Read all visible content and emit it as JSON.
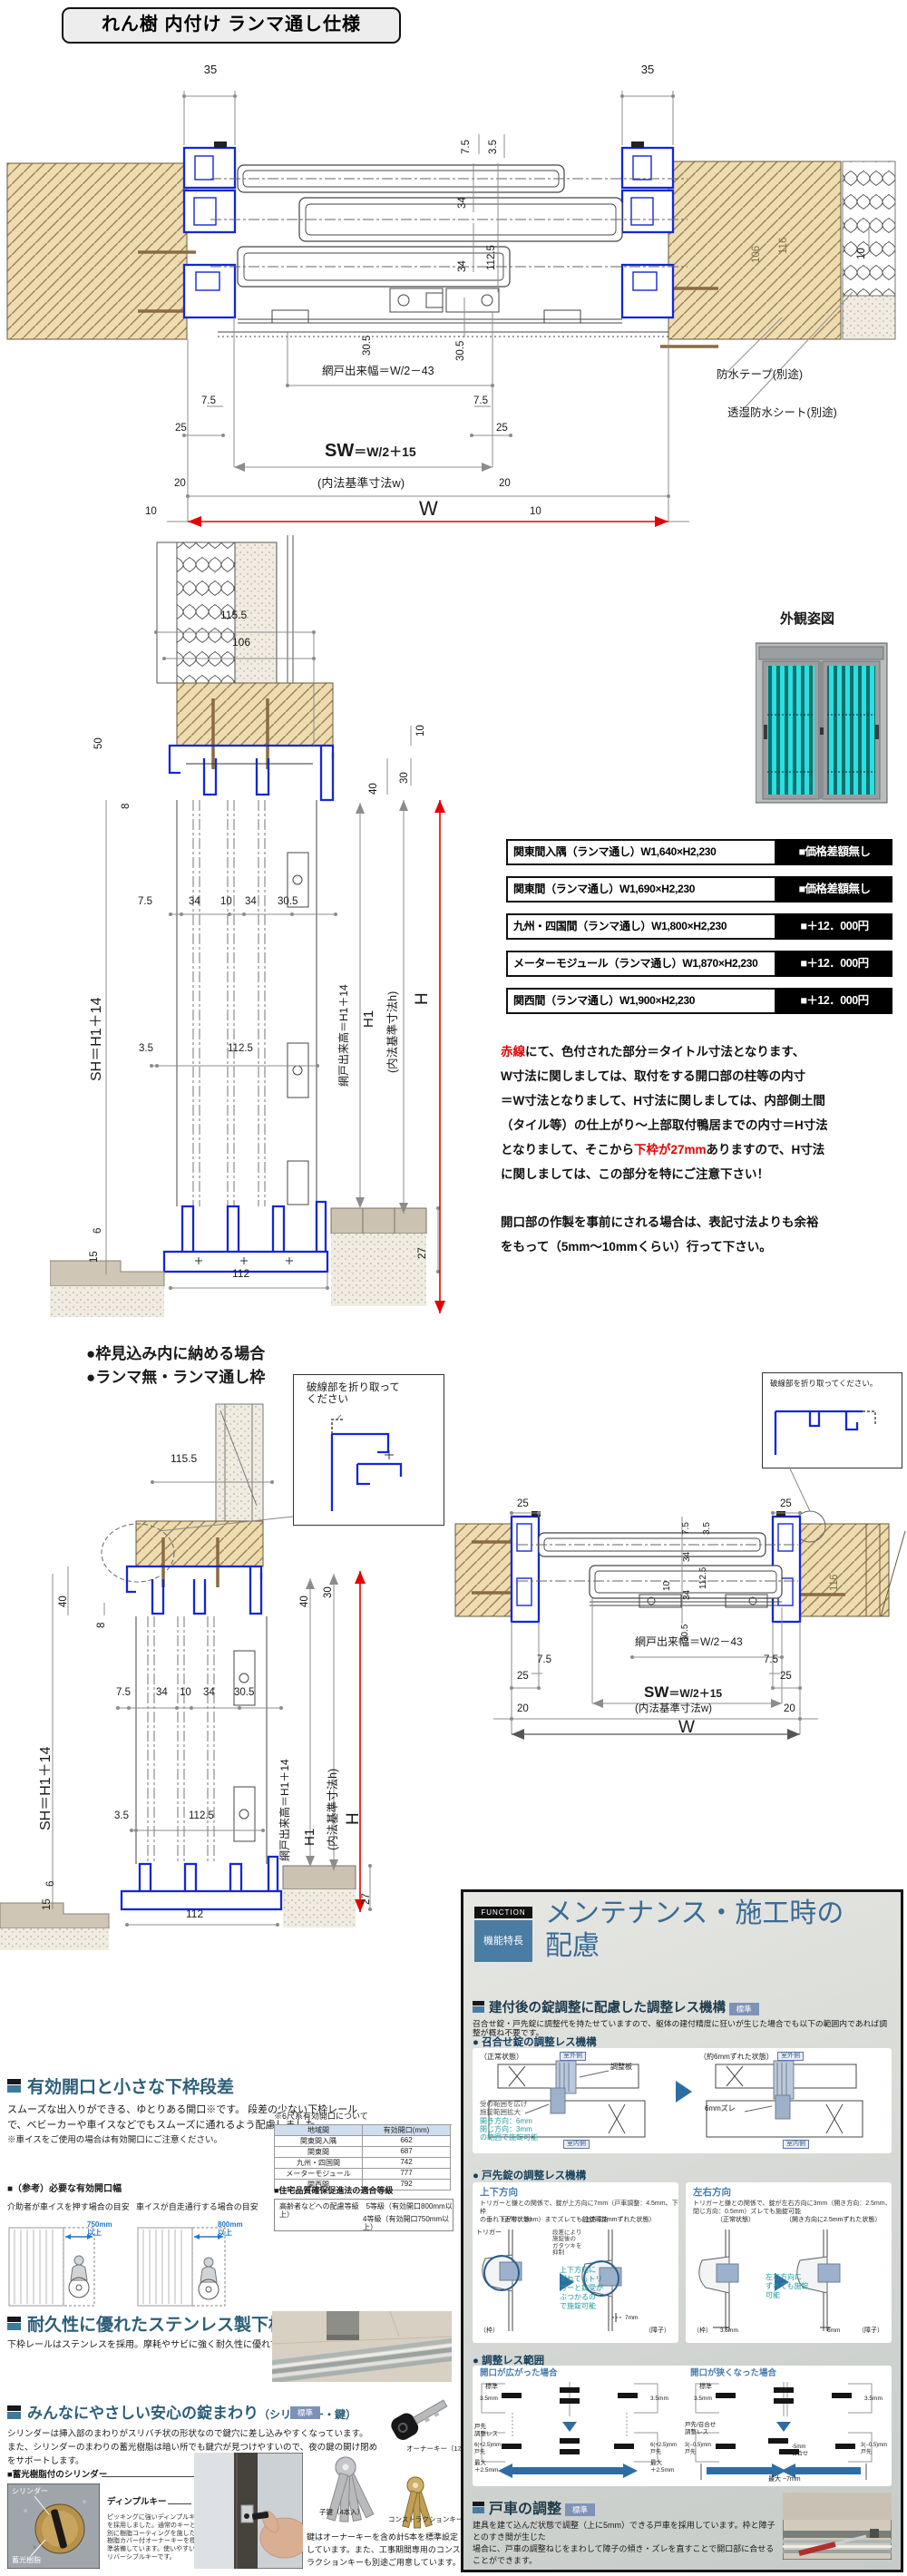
{
  "title": "れん樹 内付け ランマ通し仕様",
  "d1": {
    "l35": "35",
    "r35": "35",
    "v75": "7.5",
    "v35": "3.5",
    "v34a": "34",
    "v1125": "112.5",
    "v34b": "34",
    "v305": "30.5",
    "v10": "10",
    "w106": "106",
    "w116": "116",
    "amido": "網戸出来幅＝W/2－43",
    "b305": "30.5",
    "b75l": "7.5",
    "b75r": "7.5",
    "b25l": "25",
    "b25r": "25",
    "sw": "SW",
    "sweq": "＝W/2＋15",
    "naiho": "(内法基準寸法w)",
    "b20l": "20",
    "b20r": "20",
    "w": "W",
    "b10l": "10",
    "b10r": "10",
    "tape": "防水テープ(別途)",
    "sheet": "透湿防水シート(別途)"
  },
  "gaikan": "外観姿図",
  "price": {
    "rows": [
      {
        "label": "関東間入隅（ランマ通し）W1,640×H2,230",
        "price": "■価格差額無し"
      },
      {
        "label": "関東間（ランマ通し）W1,690×H2,230",
        "price": "■価格差額無し"
      },
      {
        "label": "九州・四国間（ランマ通し）W1,800×H2,230",
        "price": "■＋12．000円"
      },
      {
        "label": "メーターモジュール（ランマ通し）W1,870×H2,230",
        "price": "■＋12．000円"
      },
      {
        "label": "関西間（ランマ通し）W1,900×H2,230",
        "price": "■＋12．000円"
      }
    ]
  },
  "notes": {
    "l1r": "赤線",
    "l1": "にて、色付された部分＝タイトル寸法となります、",
    "l2": "W寸法に関しましては、取付をする開口部の柱等の内寸",
    "l3": "＝W寸法となりまして、H寸法に関しましては、内部側土間",
    "l4": "（タイル等）の仕上がり～上部取付鴨居までの内寸＝H寸法",
    "l5a": "となりまして、そこから",
    "l5r": "下枠が27mm",
    "l5b": "ありますので、H寸法",
    "l6": "に関しましては、この部分を特にご注意下さい！",
    "p2": "開口部の作製を事前にされる場合は、表記寸法よりも余裕\nをもって（5mm～10mmくらい）行って下さい。"
  },
  "d2": {
    "v1155": "115.5",
    "v106": "106",
    "t10": "10",
    "t40": "40",
    "t30": "30",
    "l50": "50",
    "l8": "8",
    "m75": "7.5",
    "m34a": "34",
    "m10": "10",
    "m34b": "34",
    "m305": "30.5",
    "sh": "SH＝H1＋14",
    "v35": "3.5",
    "v1125": "112.5",
    "amido": "網戸出来高＝H1＋14",
    "h1": "H1",
    "naiho": "(内法基準寸法h)",
    "h": "H",
    "b27": "27",
    "b112": "112",
    "l6": "6",
    "l15": "15"
  },
  "mid": {
    "h1": "●枠見込み内に納める場合",
    "h2": "●ランマ無・ランマ通し枠",
    "c1": "破線部を折り取って\nください",
    "c2": "破線部を折り取ってください。"
  },
  "secA": {
    "title": "有効開口と小さな下枠段差",
    "body": "スムーズな出入りができる、ゆとりある開口※です。 段差の少ない下枠レール\nで、ベビーカーや車イスなどでもスムーズに通れるよう配慮しました。",
    "note": "※車イスをご使用の場合は有効開口にご注意ください。",
    "ref": "■（参考）必要な有効開口幅",
    "cap1": "介助者が車イスを押す場合の目安",
    "cap2": "車イスが自走通行する場合の目安",
    "arw1": "750mm\n以上",
    "arw2": "800mm\n以上",
    "tbl": {
      "title": "※6尺系有効開口について",
      "h1": "地域間",
      "h2": "有効開口(mm)",
      "rows": [
        [
          "関東間入隅",
          "662"
        ],
        [
          "関東間",
          "687"
        ],
        [
          "九州・四国間",
          "742"
        ],
        [
          "メーターモジュール",
          "777"
        ],
        [
          "関西間",
          "792"
        ]
      ]
    },
    "grade": {
      "title": "■住宅品質確保促進法の適合等級",
      "l1": "高齢者などへの配慮等級　5等級（有効開口800mm以上）",
      "l2": "4等級（有効開口750mm以上）"
    }
  },
  "secB": {
    "title": "耐久性に優れたステンレス製下枠",
    "body": "下枠レールはステンレスを採用。摩耗やサビに強く耐久性に優れています。"
  },
  "secC": {
    "title": "みんなにやさしい安心の錠まわり",
    "sub_title": "（シリンダー・鍵）",
    "badge": "標準",
    "body": "シリンダーは挿入部のまわりがスリバチ状の形状なので鍵穴に差し込みやすくなっています。\nまた、シリンダーのまわりの蓄光樹脂は暗い所でも鍵穴が見つけやすいので、夜の鍵の開け閉め\nをサポートします。",
    "sub": "■蓄光樹脂付のシリンダー",
    "cyl": "シリンダー",
    "resin": "蓄光樹脂",
    "dimple": "ディンプルキー",
    "dimple_body": "ピッキングに強いディンプルキー\nを採用しました。通常のキーとは\n別に樹脂コーティングを施した\n樹脂カバー付オーナーキーを標\n準装備しています。使いやすい\nリバーシブルキーです。",
    "owner": "オーナーキー（1本入）",
    "child": "子鍵（4本入）",
    "constr": "コンストラクションキー",
    "keysnote": "鍵はオーナーキーを含め計5本を標準設定\nしています。また、工事期間専用のコンスト\nラクションキーも別途ご用意しています。"
  },
  "panel": {
    "fn": "FUNCTION",
    "kn": "機能特長",
    "t1": "メンテナンス・施工時の",
    "t2": "配慮",
    "badge": "標準",
    "s1": "建付後の錠調整に配慮した調整レス機構",
    "intro": "召合せ錠・戸先錠に調整代を持たせていますので、躯体の建付精度に狂いが生じた場合でも以下の範囲内であれば調整が概ね不要です。",
    "b1": "● 召合せ錠の調整レス機構",
    "normal": "（正常状態）",
    "outdoor": "室外側",
    "indoor": "室内側",
    "plate": "調整板",
    "range": "受の範囲を広げ\n施錠範囲拡大",
    "teal1": "開き方向：6mm\n閉じ方向：3mm\nの範囲で施錠可能",
    "shift6": "（約6mmずれた状態）",
    "zure": "6mmズレ",
    "b2": "● 戸先錠の調整レス機構",
    "ud": "上下方向",
    "ud_body": "トリガーと鎌との関係で、錠が上方向に7mm（戸車調整：4.5mm、下枠\nの垂れ下がり：2mm）までズレても施錠可能",
    "ud_shift": "（上方向7mmずれた状態）",
    "trigger": "トリガー",
    "gata": "段差により\n施錠後の\nガタツキを\n抑制",
    "ud_teal": "上下方向に\nずれてもトリ\nガーと錠受が\nぶつかるの\nで施錠可能",
    "waku": "（枠）",
    "shoji": "（障子）",
    "mm7": "7mm",
    "lr": "左右方向",
    "lr_body": "トリガーと鎌との関係で、錠が左右方向に3mm（開き方向：2.5mm、\n閉じ方向：0.5mm）ズレても施錠可能",
    "lr_shift": "（開き方向に2.5mmずれた状態）",
    "lr_teal": "左右方向に\nずれても施錠\n可能",
    "mm35": "3.5mm",
    "mm6": "6mm",
    "b3": "● 調整レス範囲",
    "case1": "開口が広がった場合",
    "case2": "開口が狭くなった場合",
    "std": "標準",
    "d35a": "3.5mm",
    "d35b": "3.5mm",
    "d35c": "3.5mm",
    "d35d": "3.5mm",
    "tres": "戸先\n調整レス",
    "v1l": "6(+2.5)mm\n戸先",
    "v1r": "6(+2.5)mm\n戸先",
    "max1l": "最大\n＋2.5mm",
    "max1r": "最大\n＋2.5mm",
    "tres2": "戸先/召合せ\n調整レス",
    "v2l": "3(−0.5)mm\n戸先",
    "v2r": "3(−0.5)mm\n戸先",
    "mav": "-5mm\n召合せ",
    "max2": "最大 −7mm",
    "s2": "戸車の調整",
    "s2body": "建具を建て込んだ状態で調整（上に5mm）できる戸車を採用しています。枠と障子とのすき間が生じた\n場合に、戸車の調整ねじをまわして障子の傾き・ズレを直すことで開口部に合せることができます。"
  }
}
